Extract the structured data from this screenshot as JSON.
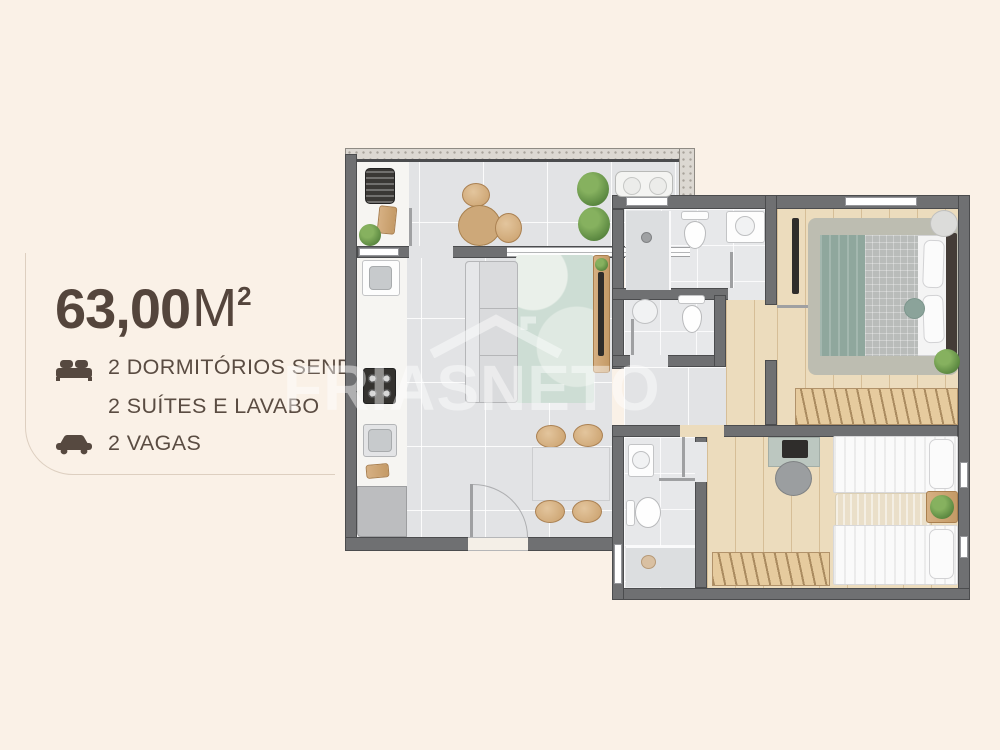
{
  "panel": {
    "area": {
      "value": "63,00",
      "unit": "M",
      "superscript": "2"
    },
    "features": [
      {
        "icon": "bed-icon",
        "line1": "2 DORMITÓRIOS SENDO",
        "line2": "2 SUÍTES E LAVABO"
      },
      {
        "icon": "car-icon",
        "line1": "2 VAGAS"
      }
    ]
  },
  "watermark": {
    "text": "FRIASNETO",
    "icon": "roof-logo-icon"
  },
  "colors": {
    "background": "#faf1e7",
    "accent_text": "#54453c",
    "wall": "#6f7072",
    "floor_tile": "#e2e3e5",
    "floor_wood": "#ecdcbd",
    "rug_living": "#cdddd4",
    "plant": "#5d8a42",
    "watermark": "rgba(255,255,255,0.45)"
  }
}
